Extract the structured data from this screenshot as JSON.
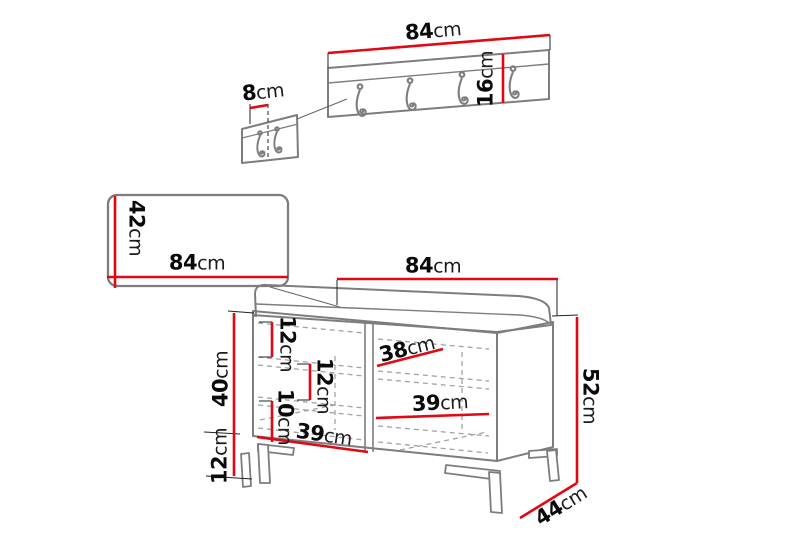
{
  "figure": {
    "accent_red": "#e30613",
    "outline_gray": "#7d7d7d",
    "background": "#ffffff"
  },
  "furniture_set": {
    "coat_rack": {
      "width": {
        "value": "84",
        "unit": "cm"
      },
      "height": {
        "value": "16",
        "unit": "cm"
      },
      "hook_panel_width": {
        "value": "8",
        "unit": "cm"
      }
    },
    "mirror_panel": {
      "height": {
        "value": "42",
        "unit": "cm"
      },
      "width": {
        "value": "84",
        "unit": "cm"
      }
    },
    "bench": {
      "width": {
        "value": "84",
        "unit": "cm"
      },
      "total_height": {
        "value": "52",
        "unit": "cm"
      },
      "depth": {
        "value": "44",
        "unit": "cm"
      },
      "carcass_height": {
        "value": "40",
        "unit": "cm"
      },
      "leg_height": {
        "value": "12",
        "unit": "cm"
      },
      "top_section_height": {
        "value": "12",
        "unit": "cm"
      },
      "middle_section_height": {
        "value": "12",
        "unit": "cm"
      },
      "bottom_section_height": {
        "value": "10",
        "unit": "cm"
      },
      "top_shelf_width": {
        "value": "38",
        "unit": "cm"
      },
      "middle_shelf_width": {
        "value": "39",
        "unit": "cm"
      },
      "bottom_shelf_width": {
        "value": "39",
        "unit": "cm"
      }
    }
  }
}
